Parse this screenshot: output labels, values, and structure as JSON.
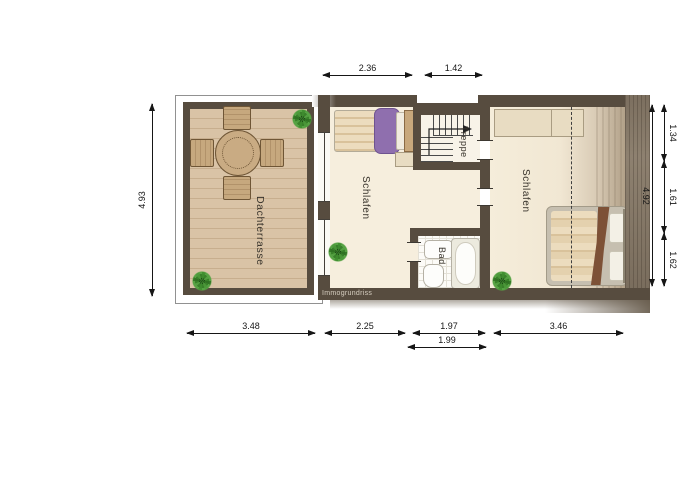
{
  "plan": {
    "watermark": "Immogrundriss",
    "rooms": {
      "terrace": {
        "label": "Dachterrasse"
      },
      "bedroom_middle": {
        "label": "Schlafen"
      },
      "bedroom_right": {
        "label": "Schlafen"
      },
      "stairs": {
        "label": "Treppe"
      },
      "bathroom": {
        "label": "Bad"
      }
    },
    "dimensions": {
      "top": [
        "2.36",
        "1.42"
      ],
      "left": [
        "4.93"
      ],
      "right_overall": "4.92",
      "right_segments": [
        "1.34",
        "1.61",
        "1.62"
      ],
      "bottom": [
        "3.48",
        "2.25",
        "1.97",
        "3.46"
      ],
      "bottom_secondary": "1.99"
    },
    "colors": {
      "wall": "#574c3f",
      "floor": "#f6eedd",
      "deck": "#d9c3a6",
      "tile": "#fcfbf7",
      "bed_purple": "#8f6fae",
      "blanket_brown": "#7d5136",
      "plant_green": "#3f8d2f"
    }
  }
}
